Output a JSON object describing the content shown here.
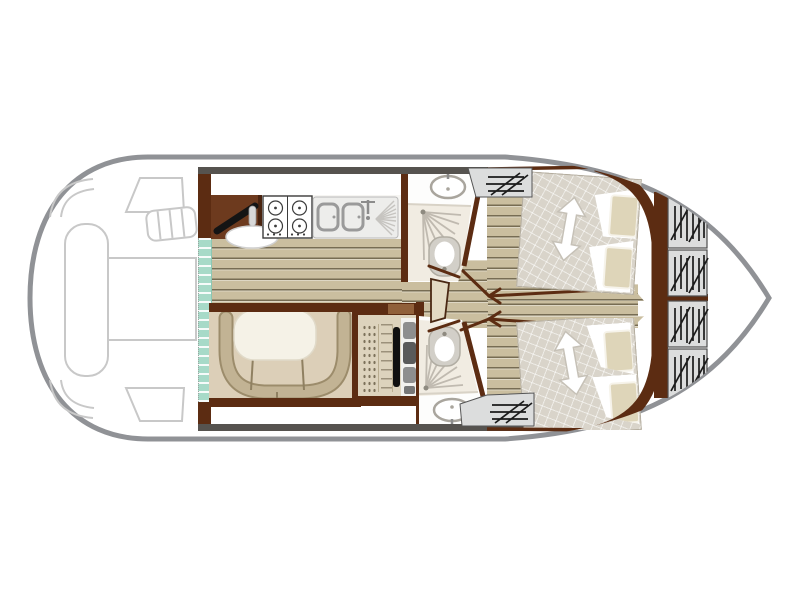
{
  "page": {
    "type": "houseboat-interior-floor-plan",
    "background": "#ffffff",
    "orientation": "bow-right"
  },
  "palette": {
    "hull_stroke": "#909296",
    "outline_gray": "#c8c8c8",
    "dark_line": "#56534f",
    "wall_brown": "#5c2c12",
    "cabinet_brown": "#6d3a1e",
    "cabinet_light": "#90603a",
    "wood_base": "#cabe9f",
    "teal": "#a7dac8",
    "room_white": "#fdfdfc",
    "shower_tint": "#f1ece2",
    "fixture_gray": "#a9a59d",
    "fan_gray": "#c0bab0",
    "mattress": "#d9d4ca",
    "pillow_tan": "#ded5b9",
    "dinette_bg": "#dccfb8",
    "sofa_tan": "#c2b394",
    "sofa_edge": "#9c8c6b",
    "table_white": "#f5f2e7",
    "helm_bg": "#ddd3bd",
    "box_gray": "#dcdddd",
    "glyph_black": "#1b1b1b",
    "arrow_white": "#ffffff",
    "arrow_edge": "#c6c1b7"
  },
  "plan": {
    "aft_deck": {
      "fixtures": [
        "sun-lounger-outline",
        "deck-table-outline",
        "corner-seat-outlines",
        "boarding-ladder"
      ]
    },
    "galley": {
      "fixtures": [
        "worktop-cabinet",
        "gas-hob-4-burner",
        "double-sink",
        "faucet",
        "drainer",
        "round-stool"
      ]
    },
    "saloon": {
      "fixtures": [
        "patio-door-teal",
        "u-shaped-sofa",
        "dining-table",
        "table-legs"
      ]
    },
    "helm_station": {
      "fixtures": [
        "step-treads",
        "steering-wheel",
        "console-controls"
      ]
    },
    "bathrooms": [
      {
        "side": "top",
        "fixtures": [
          "washbasin",
          "faucet",
          "shower-spray",
          "toilet",
          "door"
        ]
      },
      {
        "side": "bottom",
        "fixtures": [
          "washbasin",
          "faucet",
          "shower-spray",
          "toilet",
          "door"
        ]
      }
    ],
    "corridor": {
      "fixtures": [
        "step-box",
        "cabin-door-marks"
      ]
    },
    "cabins": [
      {
        "side": "top",
        "fixtures": [
          "double-bed",
          "pillow",
          "pillow",
          "direction-arrow"
        ]
      },
      {
        "side": "bottom",
        "fixtures": [
          "double-bed",
          "pillow",
          "pillow",
          "direction-arrow"
        ]
      }
    ],
    "bow_deck": {
      "fixtures": [
        "locker-hatch",
        "locker-hatch",
        "locker-hatch",
        "locker-hatch"
      ]
    },
    "side_hatches": [
      {
        "side": "top"
      },
      {
        "side": "bottom"
      }
    ]
  }
}
